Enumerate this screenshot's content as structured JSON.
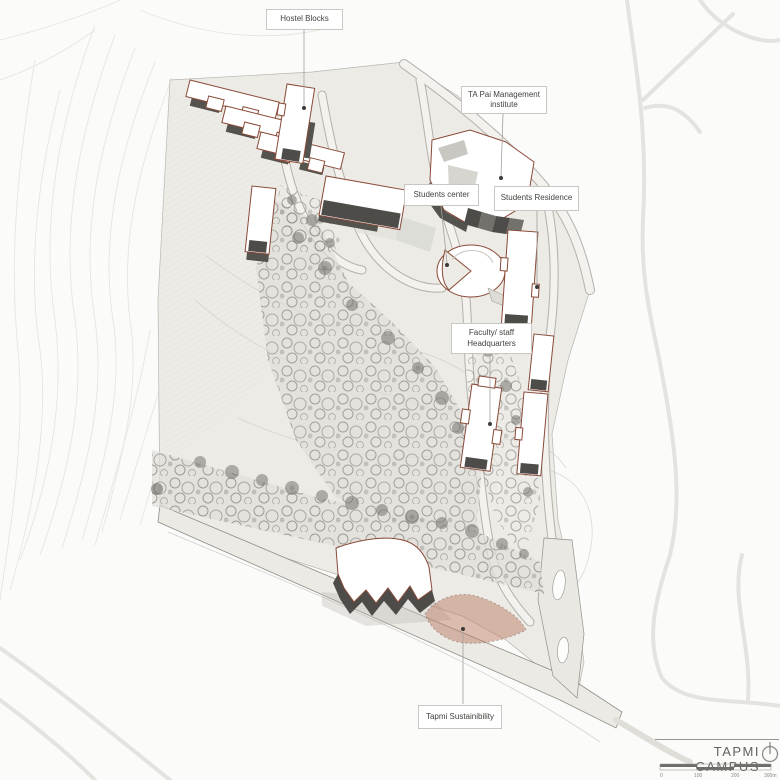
{
  "map": {
    "title": "TAPMI CAMPUS",
    "north_icon": "north-arrow-icon",
    "scale_bar": {
      "ticks": [
        "0",
        "100",
        "200",
        "300m"
      ]
    },
    "labels": [
      {
        "id": "hostel-blocks",
        "text": "Hostel Blocks"
      },
      {
        "id": "ta-pai-management-institute",
        "text": "TA Pai Management institute"
      },
      {
        "id": "students-center",
        "text": "Students center"
      },
      {
        "id": "students-residence",
        "text": "Students Residence"
      },
      {
        "id": "faculty-staff-headquarters",
        "text": "Faculty/ staff Headquarters"
      },
      {
        "id": "tapmi-sustainability",
        "text": "Tapmi Sustainibility"
      }
    ],
    "colors": {
      "background": "#fbfbfa",
      "campus_ground": "#ecebe6",
      "road_fill": "#f3f2ee",
      "building_outline": "#8a4a38",
      "building_shadow": "#55534e",
      "forest_gray": "#8d8b86",
      "sustainability_fill": "#bc7e66",
      "label_text": "#44413d",
      "title_text": "#63625e"
    }
  }
}
